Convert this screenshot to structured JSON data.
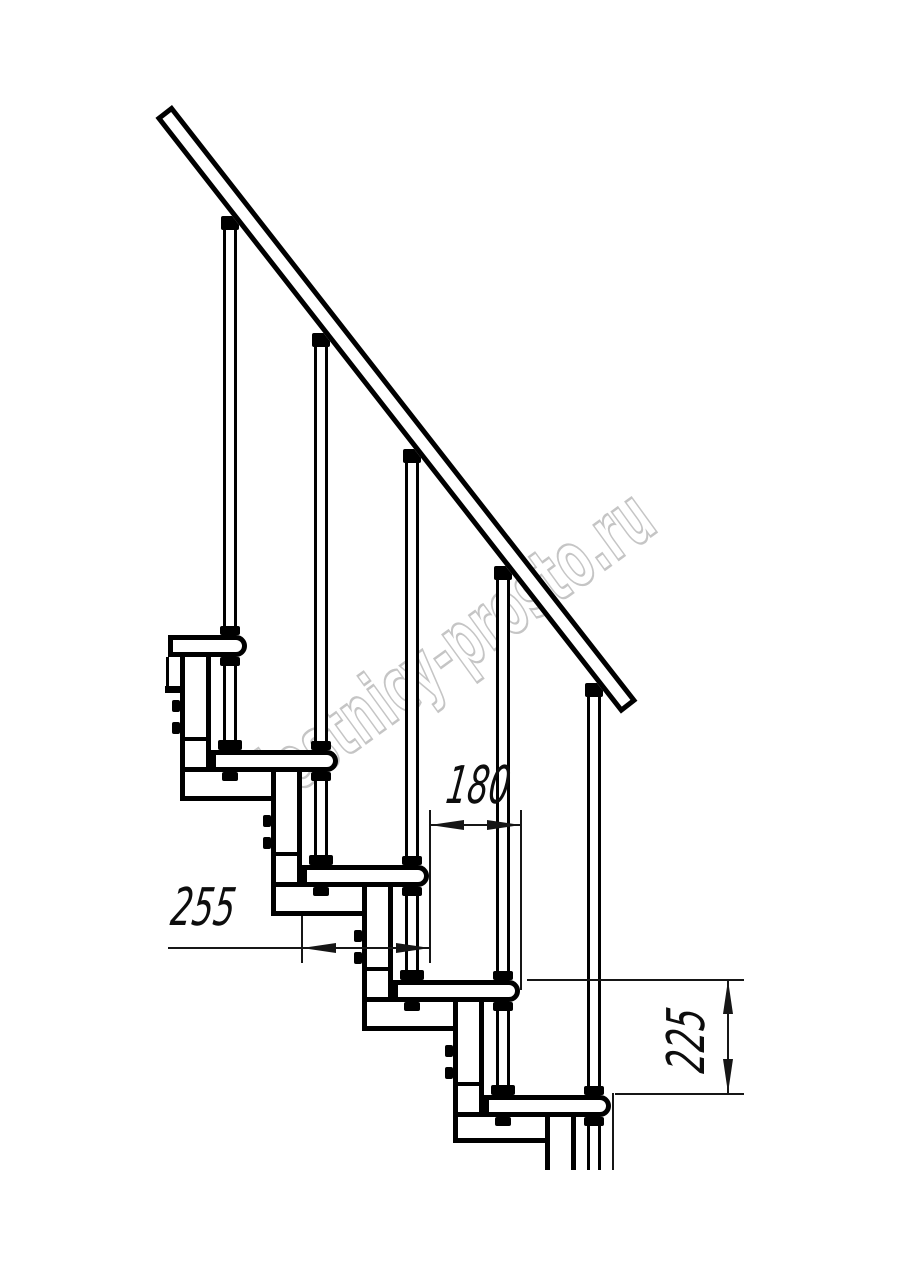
{
  "watermark": {
    "text": "lestnicy-prosto.ru"
  },
  "dimensions": {
    "tread_depth": {
      "label": "255"
    },
    "step_going": {
      "label": "180"
    },
    "step_rise": {
      "label": "225"
    }
  }
}
